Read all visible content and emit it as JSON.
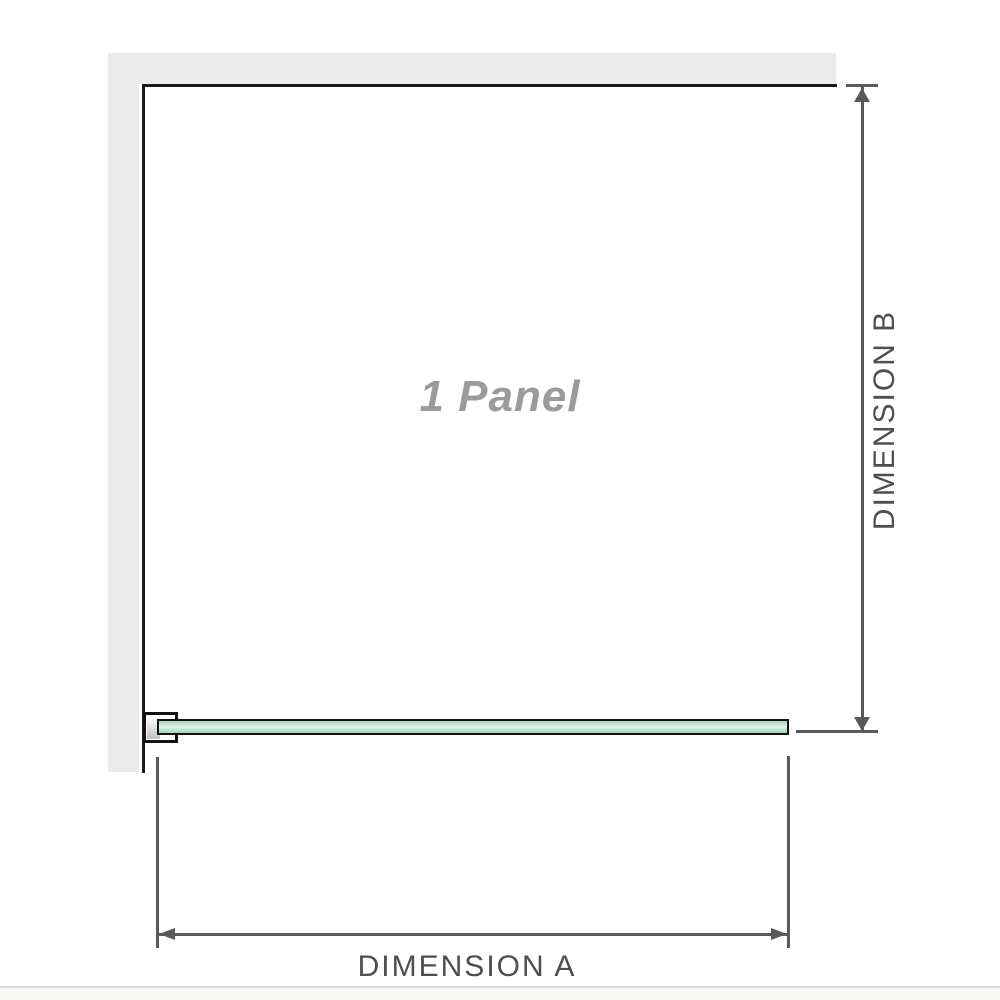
{
  "diagram": {
    "labels": {
      "panel": "1 Panel",
      "dimension_a": "DIMENSION A",
      "dimension_b": "DIMENSION B"
    },
    "colors": {
      "wall_fill": "#ebebeb",
      "frame_stroke": "#1a1a1a",
      "glass_stroke": "#121212",
      "glass_green_dark": "#9fd6b5",
      "glass_green_mid": "#c2e6cf",
      "glass_green_light": "#e6f5ea",
      "bracket_fill": "#ffffff",
      "bracket_shim_gray": "#c0c0c0",
      "dimension_stroke": "#58595b",
      "panel_label_text": "#9b9b9b",
      "dimension_label_text": "#4d4f52",
      "divider": "#d9d9d4",
      "footer_bg": "#f8f8f5"
    }
  }
}
